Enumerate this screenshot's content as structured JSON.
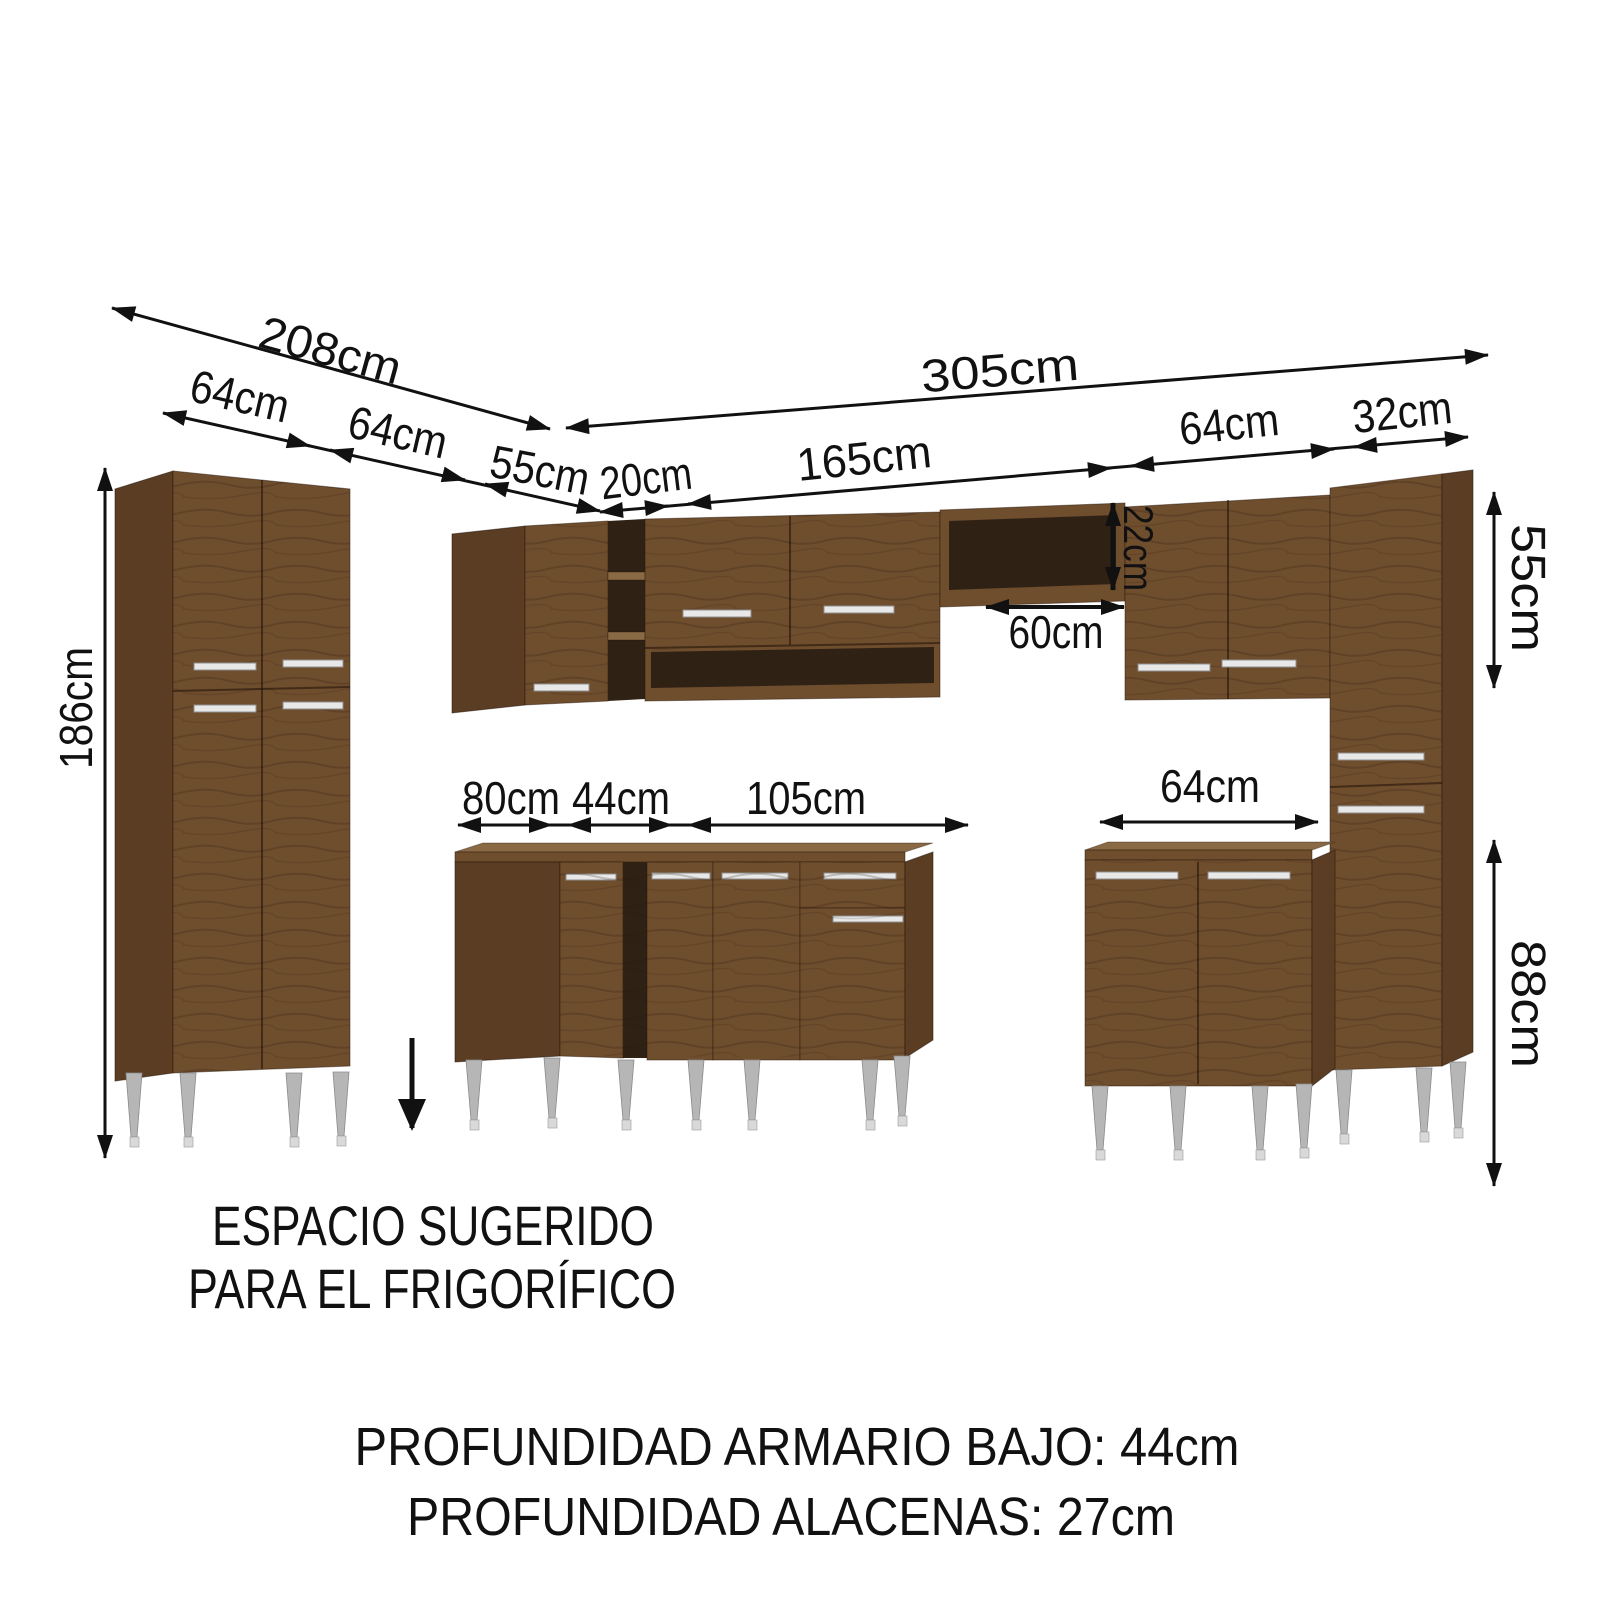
{
  "dimensions": {
    "total_depth_left": "208cm",
    "left_segment_1": "64cm",
    "left_segment_2": "64cm",
    "left_segment_3": "55cm",
    "total_width_top": "305cm",
    "top_segment_1": "20cm",
    "top_segment_2": "165cm",
    "top_segment_3": "64cm",
    "top_segment_4": "32cm",
    "pantry_height": "186cm",
    "upper_shelf_height": "22cm",
    "upper_shelf_gap": "60cm",
    "base_segment_1": "80cm",
    "base_segment_2": "44cm",
    "base_segment_3": "105cm",
    "base_right_width": "64cm",
    "upper_cabinet_height": "55cm",
    "base_cabinet_height": "88cm"
  },
  "annotations": {
    "fridge_space_line1": "ESPACIO SUGERIDO",
    "fridge_space_line2": "PARA EL FRIGORÍFICO",
    "depth_note_line1": "PROFUNDIDAD ARMARIO BAJO: 44cm",
    "depth_note_line2": "PROFUNDIDAD ALACENAS: 27cm"
  },
  "colors": {
    "background": "#ffffff",
    "line": "#111111",
    "wood": "#6f4e2e",
    "wood-dark": "#5b3d24",
    "wood-light": "#8a6a45",
    "interior": "#302115",
    "handle": "#e8e8e8",
    "leg": "#b6b6b6",
    "leg-foot": "#d9d9d9"
  }
}
